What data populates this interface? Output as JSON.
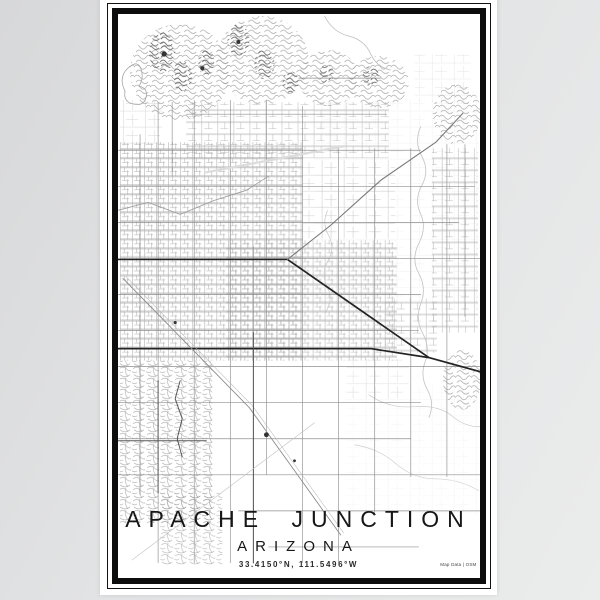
{
  "title_block": {
    "title": "APACHE JUNCTION",
    "subtitle": "ARIZONA",
    "coordinates": "33.4150°N, 111.5496°W",
    "credit": "Map Data | OSM"
  },
  "poster": {
    "paper_color": "#ffffff",
    "frame_color": "#0d0d0d",
    "background_gradient": [
      "#d7d8d9",
      "#ebecec"
    ]
  },
  "map": {
    "width": 361,
    "height": 563,
    "colors": {
      "grid": "#8f8f8f",
      "road_major": "#232323",
      "road_medium": "#7a7a7a",
      "terrain": "#9b9b9b",
      "wash": "#c2c2c2",
      "spot": "#333333"
    },
    "vlines": [
      [
        22,
        120,
        480
      ],
      [
        40,
        88,
        548
      ],
      [
        54,
        88,
        162
      ],
      [
        76,
        86,
        548
      ],
      [
        112,
        86,
        548
      ],
      [
        135,
        232,
        548
      ],
      [
        148,
        86,
        460
      ],
      [
        184,
        92,
        548
      ],
      [
        220,
        134,
        548
      ],
      [
        256,
        134,
        500
      ],
      [
        292,
        134,
        462
      ],
      [
        328,
        130,
        462
      ],
      [
        346,
        130,
        302
      ]
    ],
    "hlines": [
      [
        64,
        180,
        262
      ],
      [
        100,
        68,
        268
      ],
      [
        136,
        0,
        302
      ],
      [
        172,
        0,
        356
      ],
      [
        208,
        0,
        340
      ],
      [
        244,
        170,
        361
      ],
      [
        280,
        0,
        302
      ],
      [
        316,
        0,
        300
      ],
      [
        352,
        0,
        361
      ],
      [
        388,
        0,
        302
      ],
      [
        424,
        0,
        292
      ],
      [
        460,
        0,
        361
      ],
      [
        496,
        120,
        361
      ],
      [
        532,
        150,
        300
      ]
    ],
    "roads": [
      {
        "pts": [
          [
            0,
            245
          ],
          [
            169,
            245
          ],
          [
            310,
            343
          ],
          [
            361,
            357
          ]
        ],
        "w": 1.7,
        "c": "#232323"
      },
      {
        "pts": [
          [
            0,
            334
          ],
          [
            252,
            334
          ],
          [
            310,
            343
          ]
        ],
        "w": 1.7,
        "c": "#232323"
      },
      {
        "pts": [
          [
            169,
            245
          ],
          [
            212,
            211
          ],
          [
            262,
            166
          ],
          [
            317,
            128
          ],
          [
            344,
            99
          ]
        ],
        "w": 1.1,
        "c": "#7a7a7a"
      },
      {
        "pts": [
          [
            5,
            264
          ],
          [
            131,
            393
          ],
          [
            222,
            520
          ]
        ],
        "w": 0.9,
        "c": "#8d8d8d"
      },
      {
        "pts": [
          [
            8,
            262
          ],
          [
            134,
            391
          ],
          [
            225,
            518
          ]
        ],
        "w": 0.5,
        "c": "#b5b5b5"
      },
      {
        "pts": [
          [
            135,
            318
          ],
          [
            135,
            548
          ]
        ],
        "w": 1.0,
        "c": "#555555"
      },
      {
        "pts": [
          [
            40,
            366
          ],
          [
            40,
            478
          ]
        ],
        "w": 1.0,
        "c": "#5a5a5a"
      },
      {
        "pts": [
          [
            0,
            426
          ],
          [
            88,
            426
          ]
        ],
        "w": 1.0,
        "c": "#5a5a5a"
      },
      {
        "pts": [
          [
            62,
            366
          ],
          [
            57,
            384
          ],
          [
            64,
            404
          ],
          [
            59,
            424
          ],
          [
            64,
            442
          ]
        ],
        "w": 0.9,
        "c": "#4a4a4a"
      },
      {
        "pts": [
          [
            14,
            545
          ],
          [
            196,
            408
          ]
        ],
        "w": 0.55,
        "c": "#c0c0c0"
      },
      {
        "pts": [
          [
            88,
            158
          ],
          [
            225,
            132
          ]
        ],
        "w": 2.2,
        "c": "#dcdcdc"
      },
      {
        "pts": [
          [
            0,
            196
          ],
          [
            30,
            188
          ],
          [
            62,
            200
          ],
          [
            96,
            186
          ],
          [
            128,
            176
          ],
          [
            150,
            162
          ]
        ],
        "w": 0.8,
        "c": "#9a9a9a"
      }
    ],
    "washes": [
      {
        "d": "M302,112 q-7,16 1,30 q8,15 0,29 q-8,15 -1,29 q6,14 -2,29 q-8,16 0,30 q8,15 2,30 q-6,16 2,30 q8,15 2,29 q-5,14 3,28 q7,13 1,27",
        "c": "#c2c2c2",
        "w": 0.8
      },
      {
        "d": "M209,196 q-6,13 1,25 q7,13 -1,26 q-7,13 0,26 q6,12 -2,25",
        "c": "#c8c8c8",
        "w": 0.7
      },
      {
        "d": "M206,2 q8,16 24,20 q16,4 22,18 q6,13 20,16",
        "c": "#bdbdbd",
        "w": 0.8
      },
      {
        "d": "M250,380 q20,14 44,12 q26,-2 40,10 q12,10 27,10",
        "c": "#cccccc",
        "w": 0.7
      },
      {
        "d": "M236,430 q24,4 40,18 q18,16 40,16 q24,0 44,12",
        "c": "#d0d0d0",
        "w": 0.7
      },
      {
        "d": "M10,54 q10,-9 13,1 q3,9 -2,17 q9,2 7,11 q-2,9 -12,7 q-11,-2 -9,-13 q-7,-14 3,-23 z",
        "c": "#a6a6a6",
        "w": 0.8
      }
    ],
    "desert": [
      {
        "x": 196,
        "y": 86,
        "w": 164,
        "h": 210,
        "o": 0.22
      },
      {
        "x": 226,
        "y": 370,
        "w": 134,
        "h": 130,
        "o": 0.16
      },
      {
        "x": 2,
        "y": 190,
        "w": 60,
        "h": 120,
        "o": 0.18
      }
    ],
    "blocks": [
      {
        "x": 2,
        "y": 128,
        "w": 182,
        "h": 218,
        "p": "dense",
        "o": 0.95
      },
      {
        "x": 68,
        "y": 88,
        "w": 202,
        "h": 56,
        "p": "med",
        "o": 0.85
      },
      {
        "x": 108,
        "y": 226,
        "w": 170,
        "h": 120,
        "p": "dense",
        "o": 0.9
      },
      {
        "x": 184,
        "y": 146,
        "w": 92,
        "h": 78,
        "p": "sparse",
        "o": 0.75
      },
      {
        "x": 2,
        "y": 346,
        "w": 92,
        "h": 162,
        "p": "subdiv",
        "o": 0.95
      },
      {
        "x": 42,
        "y": 478,
        "w": 62,
        "h": 72,
        "p": "subdiv",
        "o": 0.8
      },
      {
        "x": 313,
        "y": 134,
        "w": 46,
        "h": 184,
        "p": "med",
        "o": 0.9
      },
      {
        "x": 266,
        "y": 284,
        "w": 52,
        "h": 54,
        "p": "med",
        "o": 0.85
      },
      {
        "x": 228,
        "y": 344,
        "w": 62,
        "h": 40,
        "p": "sparse",
        "o": 0.5
      },
      {
        "x": 2,
        "y": 86,
        "w": 42,
        "h": 46,
        "p": "sparse",
        "o": 0.65
      },
      {
        "x": 296,
        "y": 40,
        "w": 56,
        "h": 48,
        "p": "sparse",
        "o": 0.4
      }
    ],
    "terrain": [
      {
        "cx": 62,
        "cy": 58,
        "rx": 50,
        "ry": 48
      },
      {
        "cx": 144,
        "cy": 46,
        "rx": 46,
        "ry": 44
      },
      {
        "cx": 210,
        "cy": 64,
        "rx": 30,
        "ry": 28
      },
      {
        "cx": 260,
        "cy": 68,
        "rx": 30,
        "ry": 26
      },
      {
        "cx": 338,
        "cy": 100,
        "rx": 24,
        "ry": 30
      },
      {
        "cx": 343,
        "cy": 365,
        "rx": 19,
        "ry": 30
      }
    ],
    "cores": [
      {
        "cx": 44,
        "cy": 38,
        "rx": 13,
        "ry": 20
      },
      {
        "cx": 64,
        "cy": 62,
        "rx": 10,
        "ry": 15
      },
      {
        "cx": 88,
        "cy": 48,
        "rx": 8,
        "ry": 13
      },
      {
        "cx": 120,
        "cy": 26,
        "rx": 11,
        "ry": 16
      },
      {
        "cx": 146,
        "cy": 50,
        "rx": 10,
        "ry": 15
      },
      {
        "cx": 172,
        "cy": 68,
        "rx": 8,
        "ry": 11
      },
      {
        "cx": 208,
        "cy": 60,
        "rx": 7,
        "ry": 10
      },
      {
        "cx": 252,
        "cy": 62,
        "rx": 8,
        "ry": 10
      }
    ],
    "spots": [
      {
        "cx": 148,
        "cy": 420,
        "r": 2.4
      },
      {
        "cx": 176,
        "cy": 446,
        "r": 1.4
      },
      {
        "cx": 46,
        "cy": 40,
        "r": 2.6
      },
      {
        "cx": 84,
        "cy": 54,
        "r": 2.0
      },
      {
        "cx": 57,
        "cy": 308,
        "r": 1.6
      },
      {
        "cx": 120,
        "cy": 28,
        "r": 2.0
      }
    ]
  }
}
